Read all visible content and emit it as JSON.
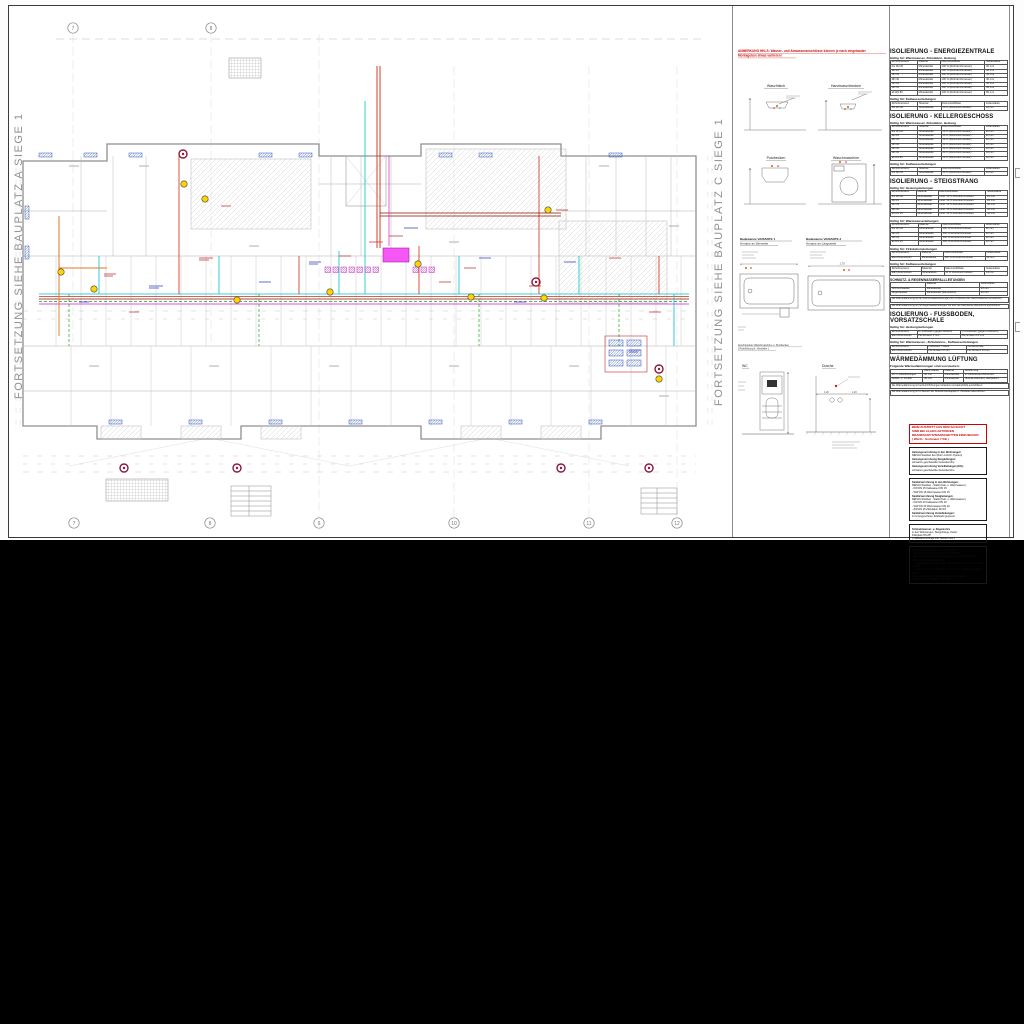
{
  "edges": {
    "left_text": "FORTSETZUNG SIEHE  BAUPLATZ A  SIEGE 1",
    "right_text": "FORTSETZUNG SIEHE  BAUPLATZ C  SIEGE 1"
  },
  "plan": {
    "axis_top": [
      "7",
      "8"
    ],
    "axis_bottom": [
      "7",
      "8",
      "9",
      "10",
      "11",
      "12"
    ]
  },
  "details": {
    "note_line1": "ANMERKUNG HKLS: Wasser- und Abwasseranschlüsse können je nach eingebauter",
    "note_line2": "Montagebox etwas variieren!",
    "fixture1": "Waschtisch",
    "fixture2": "Handwaschbecken",
    "fixture3": "Putzbecken",
    "fixture4": "Waschmaschine",
    "bath1_l1": "Badewanne VARIANTE 1",
    "bath1_l2": "Armatur an Stirnseite",
    "bath2_l1": "Badewanne VARIANTE 2",
    "bath2_l2": "Armatur an Längsseite",
    "box_caption1": "Anschlussbox Waschmaschine u. Putzbecken",
    "box_caption2": "( Rohrführung lt. Hersteller )",
    "wc_label": "WC",
    "dusche_label": "Dusche",
    "dim_shower": "1,20",
    "dim_bath": "1,70"
  },
  "tables": {
    "s1_title": "ISOLIERUNG - ENERGIEZENTRALE",
    "s1_sub1": "Gültig für: Warmwasser, Zirkulation, Heizung",
    "s1_t1": {
      "header": [
        "Rohrdimension",
        "Material",
        "Dämmstoffdicke",
        "Isolierstärke"
      ],
      "rows": [
        [
          "bis DN 20",
          "Mineralwolle",
          "100 % (Rohrdurchmesser)",
          "30 mm"
        ],
        [
          "DN 25",
          "Mineralwolle",
          "100 % (Rohrdurchmesser)",
          "30 mm"
        ],
        [
          "DN 32",
          "Mineralwolle",
          "100 % (Rohrdurchmesser)",
          "40 mm"
        ],
        [
          "DN 40",
          "Mineralwolle",
          "100 % (Rohrdurchmesser)",
          "40 mm"
        ],
        [
          "DN 50",
          "Mineralwolle",
          "100 % (Rohrdurchmesser)",
          "50 mm"
        ],
        [
          "DN 65",
          "Mineralwolle",
          "100 % (Rohrdurchmesser)",
          "60 mm"
        ],
        [
          "ab DN 80",
          "Mineralwolle",
          "100 % (Rohrdurchmesser)",
          "80 mm"
        ]
      ]
    },
    "s1_sub2": "Gültig für: Kaltwasserleitungen",
    "s1_t2": {
      "header": [
        "Rohrdimension",
        "Material",
        "Dämmstoffdicke",
        "Isolierstärke"
      ],
      "rows": [
        [
          "bis DN 50",
          "Mineralwolle",
          "50 % (Rohrdurchmesser)",
          "13 mm"
        ]
      ]
    },
    "s2_title": "ISOLIERUNG - KELLERGESCHOSS",
    "s2_sub1": "Gültig für: Warmwasser, Zirkulation, Heizung",
    "s2_t1": {
      "header": [
        "Rohrdimension",
        "Material",
        "Dämmstoffdicke",
        "Isolierstärke"
      ],
      "rows": [
        [
          "bis DN 20",
          "Mineralwolle",
          "50 % (Rohrdurchmesser)",
          "20 mm"
        ],
        [
          "DN 25",
          "Mineralwolle",
          "50 % (Rohrdurchmesser)",
          "20 mm"
        ],
        [
          "DN 32",
          "Mineralwolle",
          "50 % (Rohrdurchmesser)",
          "30 mm"
        ],
        [
          "DN 40",
          "Mineralwolle",
          "50 % (Rohrdurchmesser)",
          "30 mm"
        ],
        [
          "DN 50",
          "Mineralwolle",
          "50 % (Rohrdurchmesser)",
          "40 mm"
        ],
        [
          "DN 65",
          "Mineralwolle",
          "50 % (Rohrdurchmesser)",
          "50 mm"
        ],
        [
          "ab DN 80",
          "Mineralwolle",
          "50 % (Rohrdurchmesser)",
          "60 mm"
        ]
      ]
    },
    "s2_sub2": "Gültig für: Kaltwasserleitungen",
    "s2_t2": {
      "header": [
        "Rohrdimension",
        "Material",
        "Dämmstoffdicke",
        "Isolierstärke"
      ],
      "rows": [
        [
          "bis DN 50",
          "Mineralwolle",
          "50 % (Rohrdurchmesser)",
          "13 mm"
        ]
      ]
    },
    "s3_title": "ISOLIERUNG - STEIGSTRANG",
    "s3_sub_a": "Gültig für: Heizungsleitungen",
    "s3_ta": {
      "header": [
        "Rohrdimension",
        "Material",
        "Dämmstoffdicke",
        "Isolierstärke"
      ],
      "rows": [
        [
          "bis DN 20",
          "Mineralwolle",
          "mind. 50 % Rohrdurchmesser",
          "20 mm"
        ],
        [
          "DN 25",
          "Mineralwolle",
          "mind. 50 % Rohrdurchmesser",
          "20 mm"
        ],
        [
          "DN 32",
          "Mineralwolle",
          "mind. 50 % Rohrdurchmesser",
          "30 mm"
        ],
        [
          "DN 40",
          "Mineralwolle",
          "mind. 50 % Rohrdurchmesser",
          "30 mm"
        ],
        [
          "ab DN 50",
          "Mineralwolle",
          "mind. 50 % Rohrdurchmesser",
          "40 mm"
        ]
      ]
    },
    "s3_sub_b": "Gültig für: Warmwasserleitungen",
    "s3_tb": {
      "header": [
        "Rohrdimension",
        "Material",
        "Dämmstoffdicke",
        "Isolierstärke"
      ],
      "rows": [
        [
          "bis DN 20",
          "Mineralwolle",
          "100 % Rohrdurchmesser",
          "30 mm"
        ],
        [
          "DN 25",
          "Mineralwolle",
          "100 % Rohrdurchmesser",
          "30 mm"
        ],
        [
          "DN 32",
          "Mineralwolle",
          "100 % Rohrdurchmesser",
          "40 mm"
        ],
        [
          "ab DN 40",
          "Mineralwolle",
          "100 % Rohrdurchmesser",
          "40 mm"
        ]
      ]
    },
    "s3_sub_c": "Gültig für: Zirkulationsleitungen",
    "s3_tc": {
      "header": [
        "Rohrdimension",
        "Material",
        "Dämmstoffdicke",
        "Isolierstärke"
      ],
      "rows": [
        [
          "alle Dimensionen",
          "Mineralwolle",
          "100 % Rohrdurchmesser",
          "30 mm"
        ]
      ]
    },
    "s3_sub_d": "Gültig für: Kaltwasserleitungen",
    "s3_td": {
      "header": [
        "Rohrdimension",
        "Material",
        "Dämmstoffdicke",
        "Isolierstärke"
      ],
      "rows": [
        [
          "alle Dimensionen",
          "Mineralwolle",
          "50 % Rohrdurchmesser",
          "13 mm"
        ]
      ]
    },
    "s3_sw_title": "SCHMUTZ- & REGENWASSERFALLLEITUNGEN",
    "s3_sw": {
      "header": [
        "",
        "Material",
        "Isolierstärke"
      ],
      "rows": [
        [
          "Schmutzwasser",
          "Mineralwolle",
          "20 mm"
        ],
        [
          "Regenwasser",
          "Mineralwolle (dampfdicht)",
          "20 mm"
        ]
      ]
    },
    "s3_note1": "Die Wärmedämmung ist bei Schmutzwasserleitungen nur im Bereich der Geschoßdecken erforderlich.",
    "s3_note2": "Die Wärmedämmung ist bei Regenwasserleitungen bis über die Dachdecke dampfdicht auszuführen.",
    "s4_title": "ISOLIERUNG - FUSSBODEN, VORSATZSCHALE",
    "s4_sub1": "Gültig für: Heizungsleitungen",
    "s4_t1": {
      "header": [
        "Rohrdimension",
        "im Fußboden (gegen beheizt)",
        "im Fußboden (gegen unbeheizt)"
      ],
      "rows": [
        [
          "alle Dimensionen",
          "PE-Schaum 6 mm",
          "PE-Schaum 13 mm"
        ]
      ]
    },
    "s4_sub2": "Gültig für: Warmwasser-, Zirkulations-, Kaltwasserleitungen",
    "s4_t2": {
      "header": [
        "Rohrdimension",
        "Fußboden / Wand",
        "Vorsatzschale"
      ],
      "rows": [
        [
          "alle Dimensionen",
          "PE-Schaum 9 mm",
          "PE-Schaum 13 mm"
        ]
      ]
    },
    "s5_title": "WÄRMEDÄMMUNG LÜFTUNG",
    "s5_intro": "Folgende Wärmedämmungen sind vorzusehen:",
    "s5_t": {
      "header": [
        "",
        "Dämmstärke",
        "Material",
        "Ausführung"
      ],
      "rows": [
        [
          "Zu- u. Abluftleitungen",
          "50 mm",
          "Mineralwolle",
          "in unbeheizten Bereichen"
        ],
        [
          "Außen- u. Fortluft",
          "30 mm",
          "Mineralwolle",
          "Alufolie kaschiert, dampfdicht"
        ]
      ]
    },
    "s5_note1": "Die Wärmedämmung ist bei Durchführungen lückenlos und dampfdicht auszuführen.",
    "s5_note2": "Die Wärmedämmung ist im Bereich der Brandschutzklappen lt. Hersteller auszuführen."
  },
  "warning": {
    "lines": [
      "BEIM AUSTRITT AUS DEM SCHACHT",
      "SIND BEI ALLEN LEITUNGEN",
      "BRANDSCHUTZMANSCHETTEN EINZUBAUEN",
      "( Würth - Sortiment 7 KB )"
    ]
  },
  "notes": {
    "box_a": [
      {
        "t": "Heizungsverrohrung in den Wohnungen:",
        "b": true
      },
      {
        "t": "REHAU Rautitan flex (Rohr-in-Rohr-System)"
      },
      {
        "t": "Heizungsverrohrung Steigleitungen:",
        "b": true
      },
      {
        "t": "schwarze geschweißte Gewinderohre"
      },
      {
        "t": "Heizungsverrohrung Verteilleitungen (KG):",
        "b": true
      },
      {
        "t": "schwarze geschweißte Gewinderohre"
      }
    ],
    "box_b": [
      {
        "t": "Sanitärverrohrung in den Wohnungen:",
        "b": true
      },
      {
        "t": "REHAU Rautitan - Stabil (Kalt- u. Warmwasser)"
      },
      {
        "t": "- KW  DN 15    Kaltwasser DN 15"
      },
      {
        "t": "- WW  DN 15    Warmwasser DN 15"
      },
      {
        "t": "Sanitärverrohrung Steigleitungen:",
        "b": true
      },
      {
        "t": "REHAU Rautitan - Stabil (Kalt- u. Warmwasser)"
      },
      {
        "t": "- KW  DN 20    Kaltwasser DN 20"
      },
      {
        "t": "- WW  DN 20    Warmwasser DN 20"
      },
      {
        "t": "- ZIR  DN 15    Zirkulation DN 15"
      },
      {
        "t": "Sanitärverrohrung Verteilleitungen:",
        "b": true
      },
      {
        "t": "im Untergeschoss: Edelstahl gepresst"
      }
    ],
    "box_c": [
      {
        "t": "Schmutzwasser- u. Regenrohre",
        "b": true
      },
      {
        "t": "in den Wohnungen, Steigstränge, Keller:"
      },
      {
        "t": "Poloplast HS-PP"
      },
      {
        "t": "( Fallwasserstränge inkl. Geberit Isol )"
      }
    ],
    "box_d": [
      {
        "t": "- Wohnungsableitungen: generell DN 50"
      },
      {
        "t": "- WC-Anschlussleitungen: generell DN 100"
      },
      {
        "t": "- bei zwei Sanitärgegenständen an einem Strang sind die Rohre in DN 70 auszuführen"
      },
      {
        "t": "- Steigleitungen für WC, HWB, WT, WM und Küche: Dimension lt. Plan"
      },
      {
        "t": "- Steigleitungen für Badewannen, Duschen, Waschmaschinen: DN 70"
      },
      {
        "t": "- Lüftungsleitungen: über Dach mit Dunsthaube"
      },
      {
        "t": "- Leitungen im Erdreich: PVC hart"
      }
    ]
  }
}
